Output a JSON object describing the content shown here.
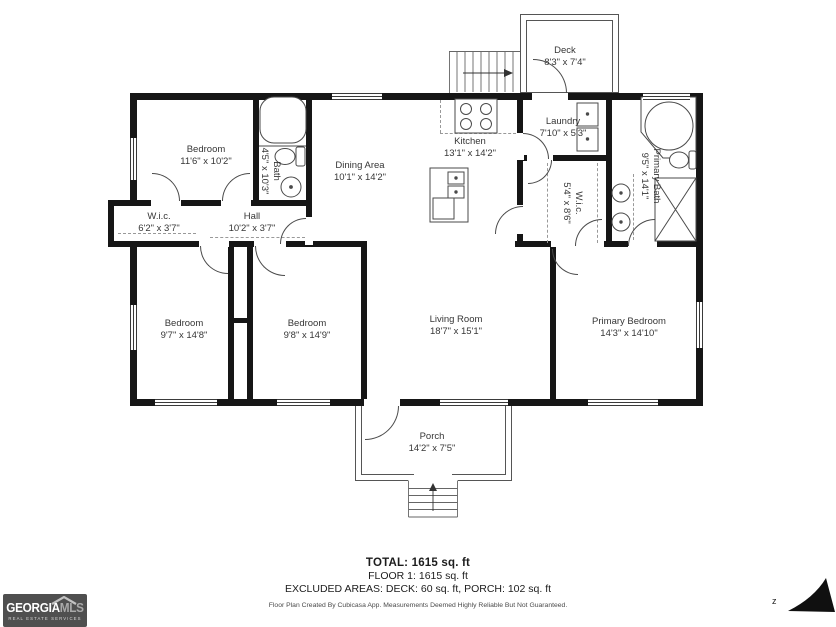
{
  "footer": {
    "total": "TOTAL: 1615 sq. ft",
    "floor": "FLOOR 1: 1615 sq. ft",
    "excluded": "EXCLUDED AREAS: DECK: 60 sq. ft, PORCH: 102 sq. ft",
    "disclaimer": "Floor Plan Created By Cubicasa App. Measurements Deemed Highly Reliable But Not Guaranteed."
  },
  "logo": {
    "brand_primary": "GEORGIA",
    "brand_secondary": "MLS",
    "tagline": "REAL ESTATE SERVICES"
  },
  "compass": {
    "label": "z"
  },
  "colors": {
    "wall": "#161616",
    "door": "#4a4a4a",
    "dash": "#999999",
    "logo_bg": "#4f4f4f",
    "text": "#363636"
  },
  "rooms": [
    {
      "name": "Deck",
      "dims": "8'3\" x 7'4\"",
      "x": 565,
      "y": 57,
      "rot": 0
    },
    {
      "name": "Bedroom",
      "dims": "11'6\" x 10'2\"",
      "x": 206,
      "y": 156,
      "rot": 0
    },
    {
      "name": "Bath",
      "dims": "4'5\" x 10'3\"",
      "x": 270,
      "y": 171,
      "rot": 90
    },
    {
      "name": "Dining Area",
      "dims": "10'1\" x 14'2\"",
      "x": 360,
      "y": 172,
      "rot": 0
    },
    {
      "name": "Kitchen",
      "dims": "13'1\" x 14'2\"",
      "x": 470,
      "y": 148,
      "rot": 0
    },
    {
      "name": "Laundry",
      "dims": "7'10\" x 5'3\"",
      "x": 563,
      "y": 128,
      "rot": 0
    },
    {
      "name": "Primary Bath",
      "dims": "9'5\" x 14'1\"",
      "x": 650,
      "y": 176,
      "rot": 90
    },
    {
      "name": "W.i.c.",
      "dims": "5'4\" x 8'6\"",
      "x": 572,
      "y": 203,
      "rot": 90
    },
    {
      "name": "W.i.c.",
      "dims": "6'2\" x 3'7\"",
      "x": 159,
      "y": 223,
      "rot": 0
    },
    {
      "name": "Hall",
      "dims": "10'2\" x 3'7\"",
      "x": 252,
      "y": 223,
      "rot": 0
    },
    {
      "name": "Bedroom",
      "dims": "9'7\" x 14'8\"",
      "x": 184,
      "y": 330,
      "rot": 0
    },
    {
      "name": "Bedroom",
      "dims": "9'8\" x 14'9\"",
      "x": 307,
      "y": 330,
      "rot": 0
    },
    {
      "name": "Living Room",
      "dims": "18'7\" x 15'1\"",
      "x": 456,
      "y": 326,
      "rot": 0
    },
    {
      "name": "Primary Bedroom",
      "dims": "14'3\" x 14'10\"",
      "x": 629,
      "y": 328,
      "rot": 0
    },
    {
      "name": "Porch",
      "dims": "14'2\" x 7'5\"",
      "x": 432,
      "y": 443,
      "rot": 0
    }
  ],
  "walls": [
    [
      130,
      93,
      573,
      7
    ],
    [
      130,
      93,
      7,
      313
    ],
    [
      130,
      399,
      573,
      7
    ],
    [
      696,
      93,
      7,
      313
    ],
    [
      108,
      200,
      204,
      6
    ],
    [
      108,
      200,
      6,
      47
    ],
    [
      108,
      241,
      259,
      6
    ],
    [
      253,
      93,
      6,
      113
    ],
    [
      306,
      93,
      6,
      153
    ],
    [
      361,
      245,
      6,
      161
    ],
    [
      228,
      247,
      6,
      159
    ],
    [
      247,
      247,
      6,
      159
    ],
    [
      228,
      318,
      25,
      5
    ],
    [
      550,
      245,
      6,
      161
    ],
    [
      515,
      241,
      188,
      6
    ],
    [
      517,
      93,
      6,
      154
    ],
    [
      523,
      155,
      89,
      6
    ],
    [
      606,
      93,
      6,
      154
    ]
  ],
  "cutouts": [
    [
      151,
      200,
      30,
      6
    ],
    [
      221,
      200,
      30,
      6
    ],
    [
      199,
      241,
      30,
      6
    ],
    [
      254,
      241,
      32,
      6
    ],
    [
      551,
      241,
      29,
      6
    ],
    [
      527,
      155,
      26,
      6
    ],
    [
      516,
      133,
      8,
      27
    ],
    [
      516,
      205,
      8,
      29
    ],
    [
      575,
      241,
      29,
      6
    ],
    [
      628,
      241,
      29,
      6
    ],
    [
      532,
      93,
      36,
      7
    ],
    [
      364,
      399,
      36,
      7
    ],
    [
      305,
      217,
      8,
      28
    ],
    [
      129,
      206,
      9,
      35
    ]
  ],
  "windows": [
    [
      332,
      93,
      50,
      7,
      "h"
    ],
    [
      643,
      93,
      47,
      7,
      "h"
    ],
    [
      130,
      138,
      7,
      42,
      "v"
    ],
    [
      130,
      305,
      7,
      45,
      "v"
    ],
    [
      155,
      399,
      62,
      7,
      "h"
    ],
    [
      277,
      399,
      53,
      7,
      "h"
    ],
    [
      440,
      399,
      68,
      7,
      "h"
    ],
    [
      588,
      399,
      70,
      7,
      "h"
    ],
    [
      696,
      302,
      7,
      46,
      "v"
    ]
  ],
  "doors": [
    [
      152,
      173,
      28,
      "bl"
    ],
    [
      222,
      173,
      28,
      "br"
    ],
    [
      200,
      246,
      28,
      "tr"
    ],
    [
      255,
      246,
      30,
      "tr"
    ],
    [
      552,
      249,
      26,
      "tr"
    ],
    [
      528,
      160,
      24,
      "tl"
    ],
    [
      523,
      133,
      26,
      "bl"
    ],
    [
      495,
      206,
      28,
      "br"
    ],
    [
      575,
      219,
      27,
      "br"
    ],
    [
      628,
      219,
      27,
      "br"
    ],
    [
      533,
      59,
      34,
      "bl"
    ],
    [
      365,
      406,
      34,
      "tl"
    ],
    [
      280,
      218,
      26,
      "br"
    ]
  ],
  "dashes": [
    [
      440,
      133,
      516,
      133
    ],
    [
      440,
      100,
      440,
      133
    ],
    [
      118,
      233,
      196,
      233
    ],
    [
      210,
      237,
      305,
      237
    ],
    [
      547,
      163,
      547,
      243
    ],
    [
      597,
      163,
      597,
      243
    ],
    [
      633,
      174,
      633,
      240
    ]
  ]
}
